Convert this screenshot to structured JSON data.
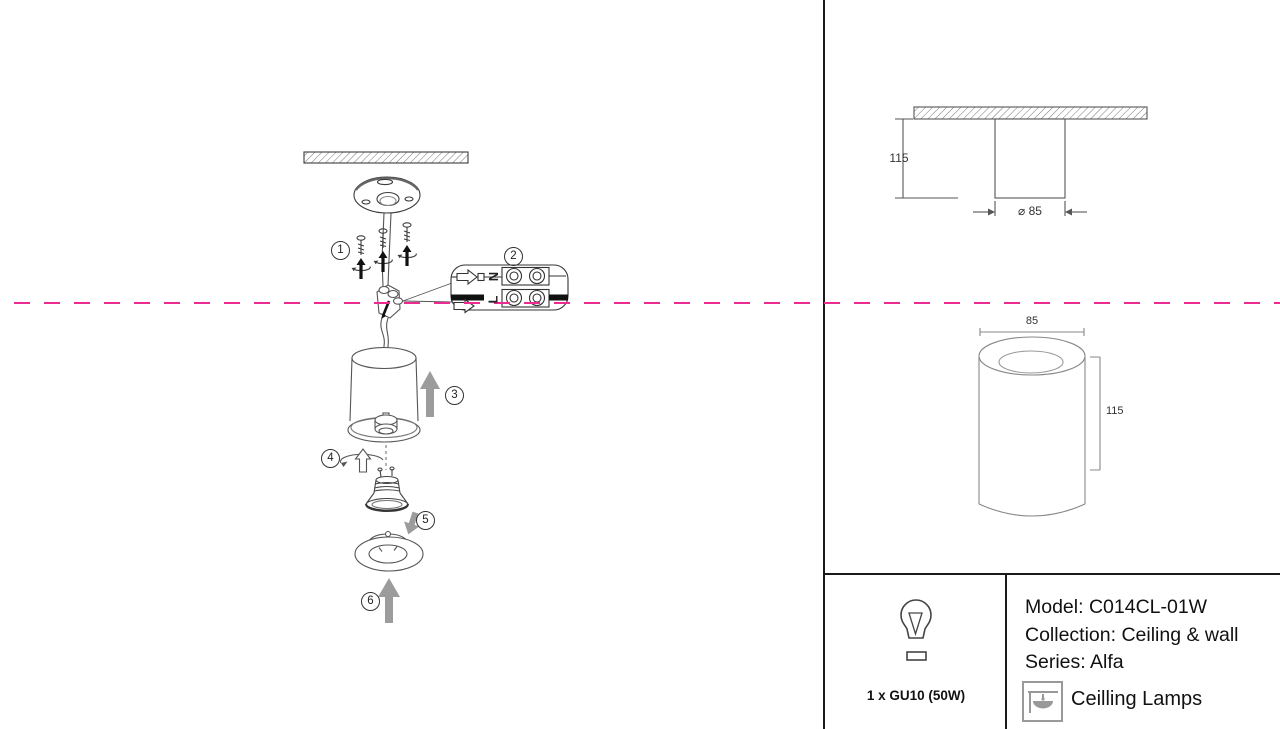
{
  "accent": {
    "dashed_line_color": "#ec2a90"
  },
  "steps": [
    {
      "label": "1"
    },
    {
      "label": "2"
    },
    {
      "label": "3"
    },
    {
      "label": "4"
    },
    {
      "label": "5"
    },
    {
      "label": "6"
    }
  ],
  "terminal_block": {
    "neutral": "N",
    "live": "L"
  },
  "dims_side_view": {
    "height": "115",
    "diameter": "⌀ 85"
  },
  "dims_front_view": {
    "width": "85",
    "height": "115"
  },
  "spec_panel": {
    "bulb": "1 x GU10 (50W)",
    "model": "Model: C014CL-01W",
    "collection": "Collection: Ceiling & wall",
    "series": "Series: Alfa",
    "category": "Ceilling Lamps"
  },
  "icons": {
    "bulb": "gu10-bulb-icon",
    "category": "ceiling-lamp-icon"
  }
}
